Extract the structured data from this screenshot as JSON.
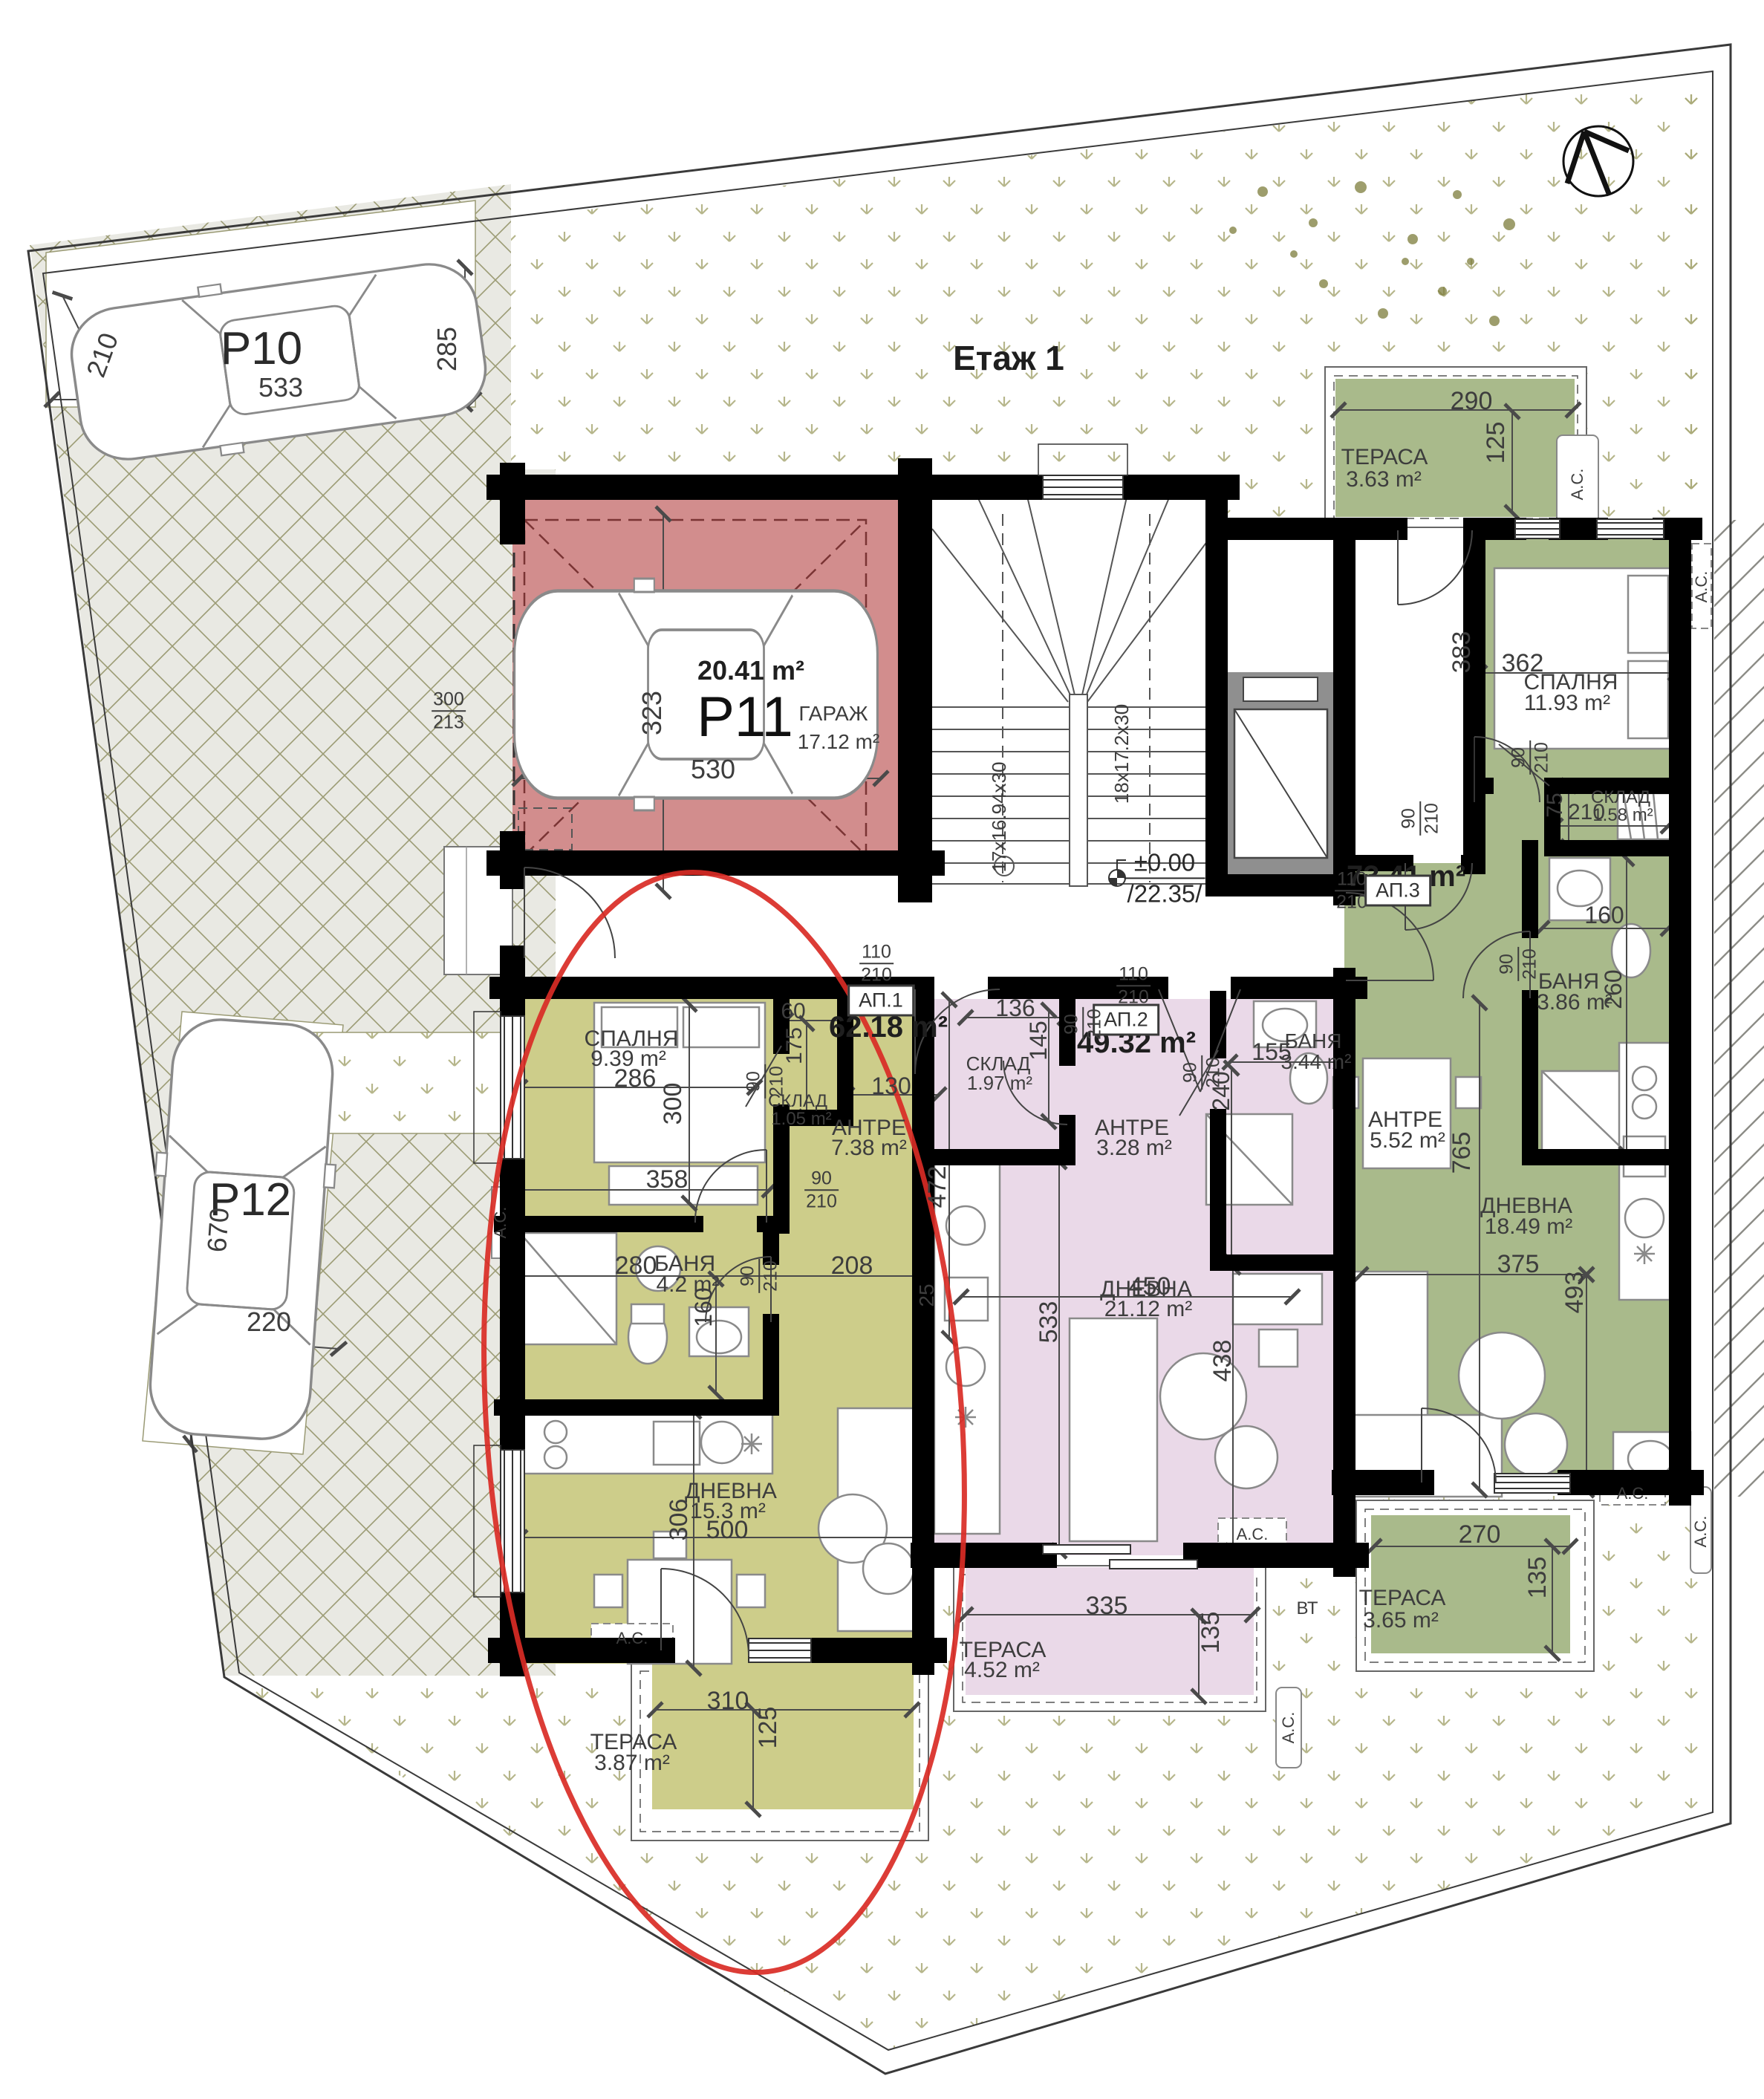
{
  "title": "Етаж 1",
  "level": {
    "zero": "±0.00",
    "abs": "/22.35/"
  },
  "stairs": {
    "f1": "17x16.94x30",
    "f2": "18x17.2x30"
  },
  "labels": {
    "ac": "А.С.",
    "bt": "ВТ"
  },
  "icons": {
    "north": "north-arrow-compass"
  },
  "colors": {
    "ap1": "#cdcd8a",
    "ap2": "#ead9e8",
    "ap3": "#a9ba8b",
    "garage": "#d28d8d",
    "highlight": "#d92b25"
  },
  "parking": {
    "p10": {
      "id": "P10",
      "w": "533",
      "d": "285",
      "s": "210"
    },
    "p11": {
      "id": "P11",
      "area": "20.41 m²",
      "room": "ГАРАЖ",
      "room_area": "17.12 m²",
      "w": "530",
      "d": "323",
      "off_a": "300",
      "off_b": "213"
    },
    "p12": {
      "id": "P12",
      "l": "670",
      "w": "220"
    }
  },
  "ap1": {
    "id": "АП.1",
    "area": "62.18 m²",
    "door_w": "110",
    "door_h": "210",
    "bedroom": {
      "name": "СПАЛНЯ",
      "area": "9.39 m²",
      "d1": "286",
      "d2": "300",
      "d3": "358"
    },
    "storage": {
      "name": "СКЛАД",
      "area": "1.05 m²",
      "d1": "60",
      "d2": "175",
      "door_w": "90",
      "door_h": "210"
    },
    "antre": {
      "name": "АНТРЕ",
      "area": "7.38 m²",
      "d1": "130",
      "d2": "472",
      "d3": "208",
      "d4": "25",
      "door_w": "90",
      "door_h": "210"
    },
    "bath": {
      "name": "БАНЯ",
      "area": "4.2 m²",
      "d1": "280",
      "d2": "160",
      "door_w": "90",
      "door_h": "210"
    },
    "living": {
      "name": "ДНЕВНА",
      "area": "15.3 m²",
      "d1": "500",
      "d2": "306"
    },
    "terrace": {
      "name": "ТЕРАСА",
      "area": "3.87 m²",
      "d1": "310",
      "d2": "125"
    }
  },
  "ap2": {
    "id": "АП.2",
    "area": "49.32 m²",
    "door_w": "110",
    "door_h": "210",
    "storage": {
      "name": "СКЛАД",
      "area": "1.97 m²",
      "d1": "136",
      "d2": "145",
      "door_w": "90",
      "door_h": "210"
    },
    "antre": {
      "name": "АНТРЕ",
      "area": "3.28 m²",
      "d1": "450"
    },
    "bath": {
      "name": "БАНЯ",
      "area": "3.44 m²",
      "d1": "155",
      "d2": "240",
      "door_w": "90",
      "door_h": "210"
    },
    "living": {
      "name": "ДНЕВНА",
      "area": "21.12 m²",
      "d1": "533",
      "d2": "438"
    },
    "terrace": {
      "name": "ТЕРАСА",
      "area": "4.52 m²",
      "d1": "335",
      "d2": "135"
    }
  },
  "ap3": {
    "id": "АП.3",
    "area": "73.41 m²",
    "door_w": "110",
    "door_h": "210",
    "terrace_n": {
      "name": "ТЕРАСА",
      "area": "3.63 m²",
      "d1": "290",
      "d2": "125"
    },
    "bedroom": {
      "name": "СПАЛНЯ",
      "area": "11.93 m²",
      "d1": "383",
      "d2": "362",
      "door_w": "90",
      "door_h": "210"
    },
    "storage": {
      "name": "СКЛАД",
      "area": "1.58 m²",
      "d1": "75",
      "d2": "210",
      "door_w": "90",
      "door_h": "210"
    },
    "bath": {
      "name": "БАНЯ",
      "area": "3.86 m²",
      "d1": "160",
      "d2": "260",
      "door_w": "90",
      "door_h": "210"
    },
    "antre": {
      "name": "АНТРЕ",
      "area": "5.52 m²",
      "door_w": "90",
      "door_h": "210"
    },
    "living": {
      "name": "ДНЕВНА",
      "area": "18.49 m²",
      "d1": "765",
      "d2": "375",
      "d3": "493"
    },
    "terrace_s": {
      "name": "ТЕРАСА",
      "area": "3.65 m²",
      "d1": "270",
      "d2": "135"
    }
  }
}
